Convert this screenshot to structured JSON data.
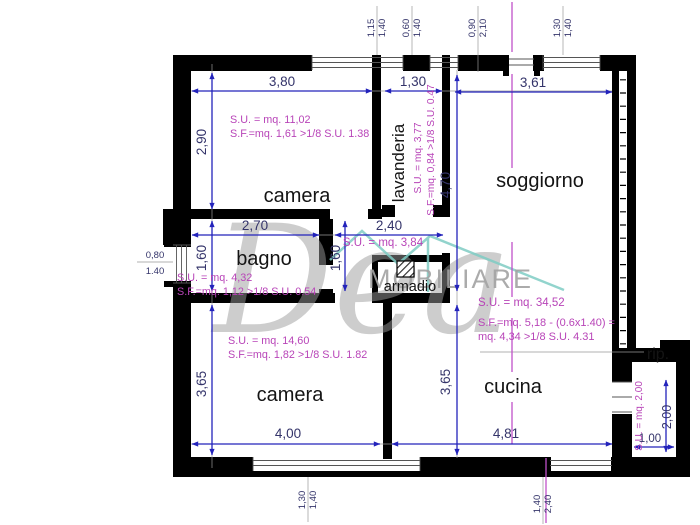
{
  "watermark": {
    "script": "Dea",
    "brand": "MOBILIARE"
  },
  "rooms": {
    "camera1": {
      "label": "camera",
      "su": "S.U. = mq. 11,02",
      "sf": "S.F.=mq. 1,61 >1/8 S.U. 1.38"
    },
    "lavanderia": {
      "label": "lavanderia",
      "su": "S.U. = mq. 3,77",
      "sf": "S.F.=mq. 0,84 >1/8 S.U. 0.47"
    },
    "soggiorno": {
      "label": "soggiorno"
    },
    "bagno": {
      "label": "bagno",
      "su": "S.U. = mq. 4,32",
      "sf": "S.F.=mq. 1,12 >1/8 S.U. 0.54"
    },
    "disimpegno": {
      "su": "S.U. = mq. 3,84"
    },
    "armadio": {
      "label": "armadio"
    },
    "camera2": {
      "label": "camera",
      "su": "S.U. = mq. 14,60",
      "sf": "S.F.=mq. 1,82 >1/8 S.U. 1.82"
    },
    "cucina": {
      "label": "cucina",
      "su": "S.U. = mq. 34,52",
      "sf_line1": "S.F.=mq. 5,18 - (0.6x1.40) =",
      "sf_line2": "mq. 4,34 >1/8 S.U. 4.31"
    },
    "rip": {
      "label": "rip.",
      "su": "S.U. = mq. 2,00"
    }
  },
  "dims": {
    "camera1_w": "3,80",
    "camera1_h": "2,90",
    "lavanderia_w": "1,30",
    "soggiorno_w": "3,61",
    "soggiorno_h": "4,70",
    "bagno_w": "2,70",
    "bagno_h": "1,60",
    "hall_w": "2,40",
    "hall_h": "1,60",
    "camera2_w": "4,00",
    "camera2_h": "3,65",
    "cucina_w": "4,81",
    "cucina_h": "3,65",
    "rip_w": "1,00",
    "rip_h": "2,00"
  },
  "openings": {
    "top": [
      {
        "w": "1,15",
        "h": "1,40"
      },
      {
        "w": "0,60",
        "h": "1,40"
      },
      {
        "w": "0,90",
        "h": "2,10"
      },
      {
        "w": "1,30",
        "h": "1,40"
      }
    ],
    "left": {
      "w": "0,80",
      "h": "1.40"
    },
    "bottom": [
      {
        "w": "1,30",
        "h": "1,40"
      },
      {
        "w": "1,40",
        "h": "2,40"
      }
    ]
  },
  "symbols": {
    "wardrobe": "hatched-square"
  },
  "colors": {
    "wall": "#000000",
    "dimension_line": "#2323bb",
    "dimension_text": "#34346a",
    "area_text": "#b844b8",
    "section_line": "#c050c8",
    "watermark_gray": "#9c9c9c",
    "watermark_teal": "#7fccc4"
  }
}
